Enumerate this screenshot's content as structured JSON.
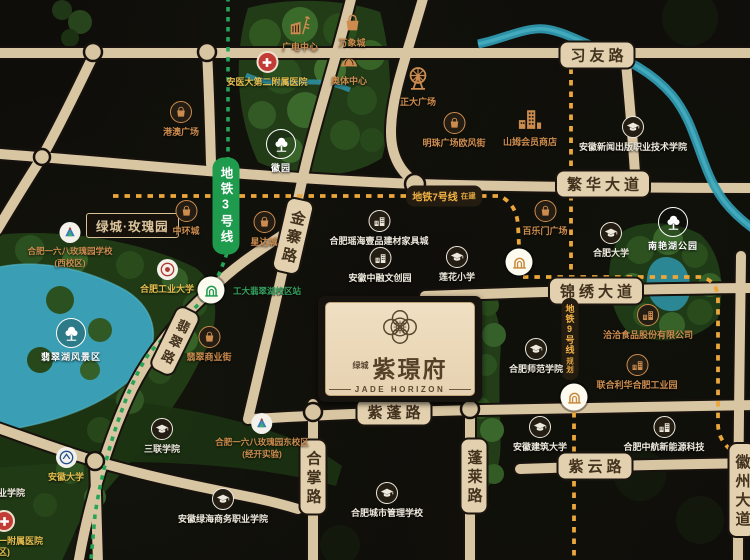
{
  "brand": {
    "company": "绿城",
    "name": "紫璟府",
    "en": "JADE HORIZON"
  },
  "roads": {
    "xiyou": "习友路",
    "fanhua": "繁华大道",
    "jinxiu": "锦绣大道",
    "zipeng": "紫蓬路",
    "ziyun": "紫云路",
    "penglai": "蓬莱路",
    "hezhang": "合掌路",
    "jinzhai": "金寨路",
    "feicui": "翡翠路",
    "huizhou": "徽州大道"
  },
  "metro": {
    "line3": {
      "name": "地铁3号线",
      "color": "#1f9b4e"
    },
    "line7": {
      "name": "地铁7号线",
      "status": "在建",
      "color": "#eba73b"
    },
    "line9": {
      "name": "地铁9号线",
      "status": "规划",
      "color": "#eba73b"
    },
    "station_line3": "工大翡翠湖校区站"
  },
  "pois": [
    {
      "name": "广电中心"
    },
    {
      "name": "万象城"
    },
    {
      "name": "安医大第二附属医院"
    },
    {
      "name": "奥体中心"
    },
    {
      "name": "正大广场"
    },
    {
      "name": "港澳广场"
    },
    {
      "name": "明珠广场欧风街"
    },
    {
      "name": "山姆会员商店"
    },
    {
      "name": "安徽新闻出版职业技术学院"
    },
    {
      "name": "徽园"
    },
    {
      "name": "绿城·玫瑰园"
    },
    {
      "name": "中环城"
    },
    {
      "name": "星达城"
    },
    {
      "name": "合肥一六八玫瑰园学校",
      "name2": "(西校区)"
    },
    {
      "name": "合肥工业大学"
    },
    {
      "name": "合肥瑶海壹品建材家具城"
    },
    {
      "name": "安徽中融文创园"
    },
    {
      "name": "莲花小学"
    },
    {
      "name": "百乐门广场"
    },
    {
      "name": "合肥大学"
    },
    {
      "name": "南艳湖公园"
    },
    {
      "name": "洽洽食品股份有限公司"
    },
    {
      "name": "合肥师范学院"
    },
    {
      "name": "联合利华合肥工业园"
    },
    {
      "name": "翡翠商业街"
    },
    {
      "name": "翡翠湖风景区"
    },
    {
      "name": "三联学院"
    },
    {
      "name": "合肥一六八玫瑰园东校区",
      "name2": "(经开实验)"
    },
    {
      "name": "安徽大学"
    },
    {
      "name": "安徽绿海商务职业学院"
    },
    {
      "name": "合肥城市管理学校"
    },
    {
      "name": "安徽建筑大学"
    },
    {
      "name": "合肥中航新能源科技"
    },
    {
      "name": "业学院"
    },
    {
      "name": "一附属医院",
      "name2": "区)"
    }
  ],
  "colors": {
    "road": "#d8c5a2",
    "water": "#3aa0b5",
    "metro_line3": "#1f9b4e",
    "metro_planned": "#eba73b",
    "poi_orange": "#cd8c4e",
    "poi_yellow": "#e3bd4e"
  }
}
